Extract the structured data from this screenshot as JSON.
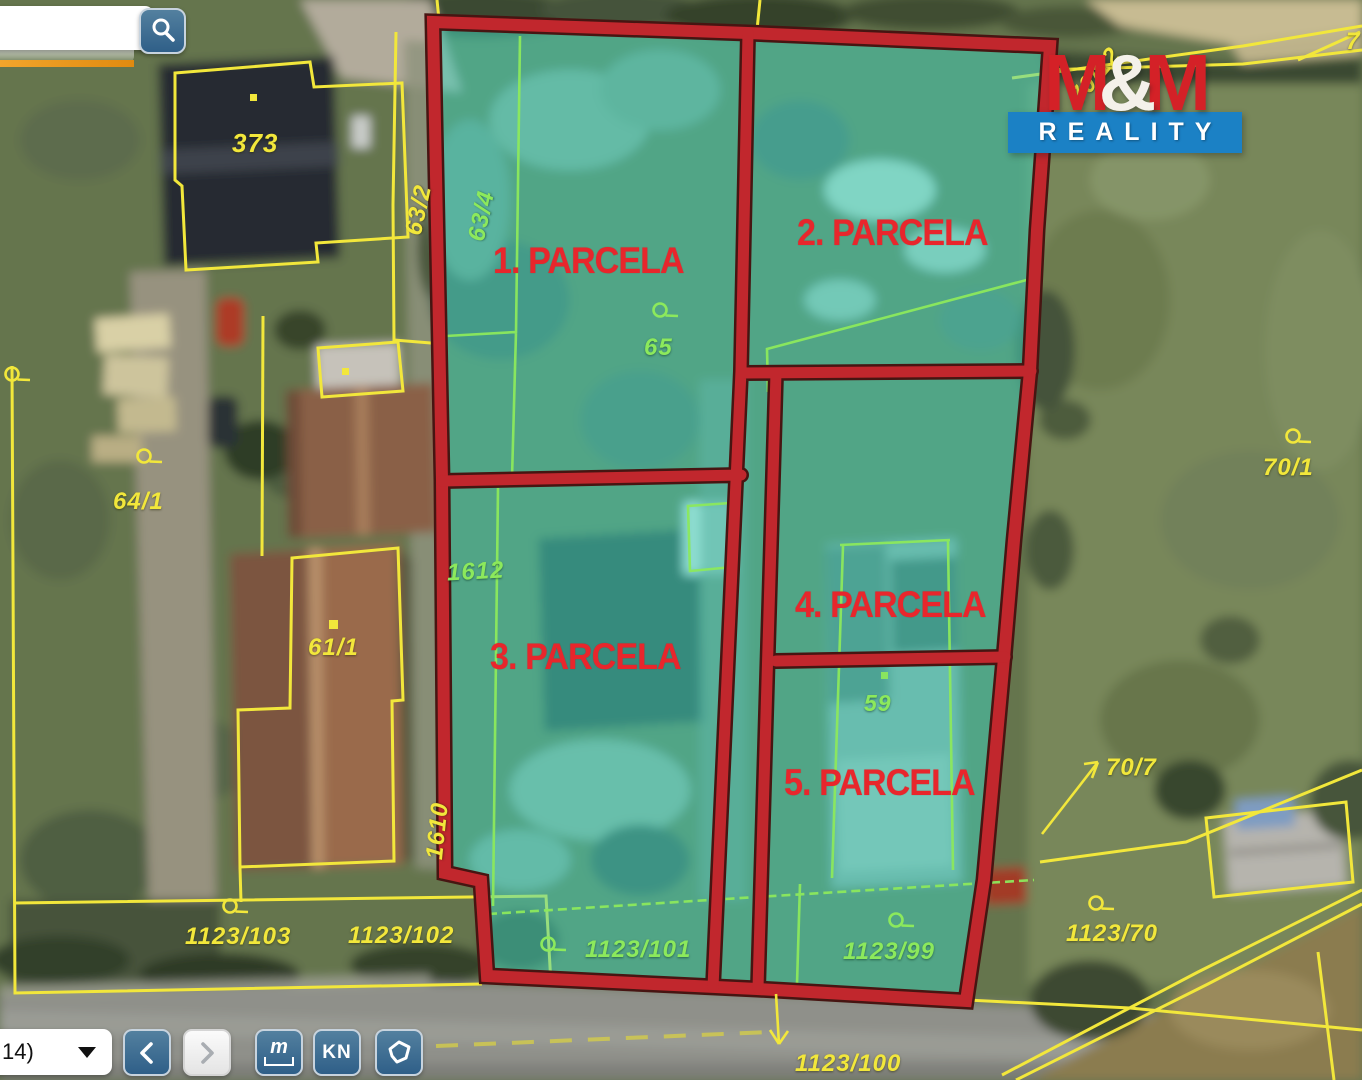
{
  "search": {
    "value": ""
  },
  "logo": {
    "m1": "M",
    "amp": "&",
    "m2": "M",
    "reality": "REALITY"
  },
  "parcels": {
    "p1": "1. PARCELA",
    "p2": "2. PARCELA",
    "p3": "3. PARCELA",
    "p4": "4. PARCELA",
    "p5": "5. PARCELA"
  },
  "cadastral": {
    "n373": "373",
    "n63_2": "63/2",
    "n63_4": "63/4",
    "n65": "65",
    "n64_1": "64/1",
    "n61_1": "61/1",
    "n1612": "1612",
    "n1610": "1610",
    "n59": "59",
    "n1123_103": "1123/103",
    "n1123_102": "1123/102",
    "n1123_101": "1123/101",
    "n1123_99": "1123/99",
    "n1123_70": "1123/70",
    "n1123_100": "1123/100",
    "n70_7": "70/7",
    "n70_1": "70/1",
    "n70_12": "70/12",
    "n7": "7"
  },
  "toolbar": {
    "select_value": "14)",
    "kn_label": "KN",
    "measure_label": "m"
  },
  "colors": {
    "parcel_fill": "#3ed6c0",
    "parcel_border": "#c1272d",
    "cadastral_yellow": "#f2e73b",
    "inner_green": "#8ce95c",
    "label_red": "#e8262c",
    "logo_red": "#d42127",
    "logo_blue": "#1b81c5",
    "button_blue": "#3c6e99"
  }
}
